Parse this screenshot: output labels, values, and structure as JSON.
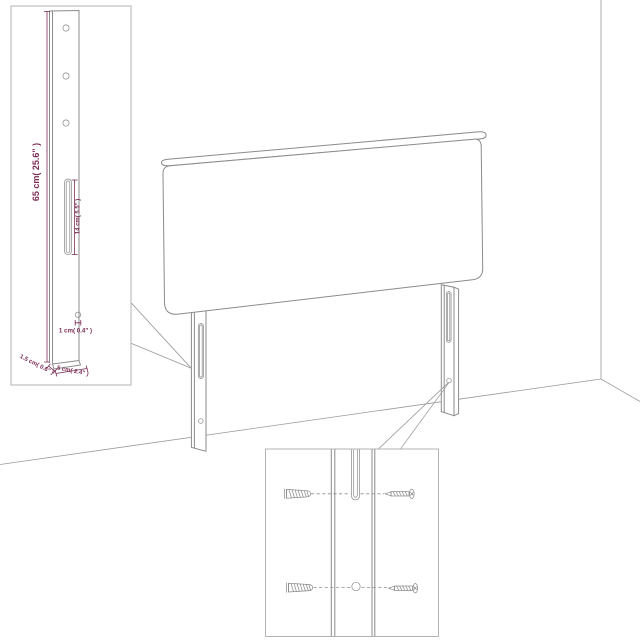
{
  "colors": {
    "dimension_text": "#7b2c55",
    "outline_gray": "#8b8b8b",
    "background": "#ffffff"
  },
  "post_detail_inset": {
    "height_label": "65 cm( 25.6\" )",
    "slot_label": "14 cm( 5.5\" )",
    "hole_label": "1 cm( 0.4\" )",
    "thickness_label": "1.5 cm( 0.6\" )",
    "width_label": "5 cm( 2.4\" )"
  }
}
